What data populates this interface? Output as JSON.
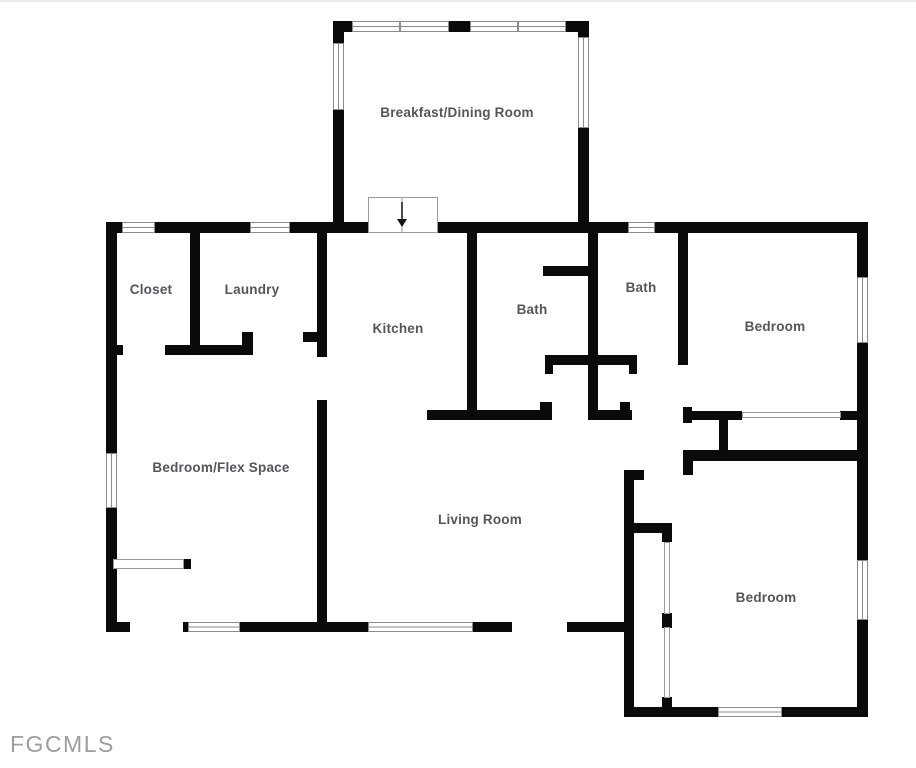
{
  "watermark": {
    "text": "FGCMLS"
  },
  "colors": {
    "background": "#ffffff",
    "wall": "#0a0a0a",
    "label": "#55555c",
    "window_stroke": "#8b8b8b",
    "watermark": "#9d9d9d",
    "page_top_edge": "#ebebe9"
  },
  "plan": {
    "canvas": {
      "width": 916,
      "height": 768
    },
    "rooms": [
      {
        "id": "breakfast-dining-room",
        "label": "Breakfast/Dining Room",
        "cx": 457,
        "cy": 117
      },
      {
        "id": "closet",
        "label": "Closet",
        "cx": 151,
        "cy": 294
      },
      {
        "id": "laundry",
        "label": "Laundry",
        "cx": 252,
        "cy": 294
      },
      {
        "id": "kitchen",
        "label": "Kitchen",
        "cx": 398,
        "cy": 333
      },
      {
        "id": "bath-center",
        "label": "Bath",
        "cx": 532,
        "cy": 314
      },
      {
        "id": "bath-right",
        "label": "Bath",
        "cx": 641,
        "cy": 292
      },
      {
        "id": "bedroom-right",
        "label": "Bedroom",
        "cx": 775,
        "cy": 331
      },
      {
        "id": "bedroom-flex-space",
        "label": "Bedroom/Flex Space",
        "cx": 221,
        "cy": 472
      },
      {
        "id": "living-room",
        "label": "Living Room",
        "cx": 480,
        "cy": 524
      },
      {
        "id": "bedroom-bottom",
        "label": "Bedroom",
        "cx": 766,
        "cy": 602
      }
    ],
    "walls": [
      [
        333,
        21,
        256,
        11
      ],
      [
        333,
        21,
        11,
        211
      ],
      [
        578,
        21,
        11,
        202
      ],
      [
        106,
        222,
        762,
        11
      ],
      [
        106,
        222,
        11,
        410
      ],
      [
        857,
        222,
        11,
        495
      ],
      [
        106,
        622,
        528,
        10
      ],
      [
        624,
        470,
        10,
        247
      ],
      [
        624,
        470,
        20,
        10
      ],
      [
        624,
        707,
        244,
        10
      ],
      [
        683,
        450,
        174,
        11
      ],
      [
        683,
        450,
        10,
        25
      ],
      [
        634,
        523,
        38,
        10
      ],
      [
        662,
        523,
        10,
        19
      ],
      [
        662,
        613,
        10,
        15
      ],
      [
        662,
        697,
        10,
        20
      ],
      [
        683,
        407,
        9,
        16
      ],
      [
        683,
        411,
        59,
        9
      ],
      [
        840,
        411,
        17,
        9
      ],
      [
        719,
        420,
        9,
        30
      ],
      [
        467,
        232,
        10,
        180
      ],
      [
        427,
        410,
        125,
        10
      ],
      [
        540,
        402,
        12,
        8
      ],
      [
        543,
        266,
        55,
        10
      ],
      [
        588,
        232,
        10,
        181
      ],
      [
        588,
        410,
        44,
        10
      ],
      [
        620,
        402,
        10,
        8
      ],
      [
        545,
        355,
        92,
        10
      ],
      [
        545,
        365,
        8,
        9
      ],
      [
        629,
        365,
        8,
        9
      ],
      [
        678,
        232,
        10,
        133
      ],
      [
        190,
        232,
        10,
        123
      ],
      [
        165,
        345,
        80,
        10
      ],
      [
        117,
        345,
        6,
        10
      ],
      [
        242,
        332,
        11,
        23
      ],
      [
        303,
        332,
        24,
        10
      ],
      [
        317,
        232,
        10,
        400
      ],
      [
        183,
        559,
        8,
        10
      ]
    ],
    "openings": [
      [
        368,
        222,
        67,
        11
      ],
      [
        130,
        622,
        53,
        10
      ],
      [
        512,
        622,
        55,
        10
      ],
      [
        317,
        357,
        10,
        43
      ]
    ],
    "windows": [
      {
        "x": 352,
        "y": 21,
        "w": 48,
        "h": 11,
        "o": "h"
      },
      {
        "x": 400,
        "y": 21,
        "w": 49,
        "h": 11,
        "o": "h"
      },
      {
        "x": 470,
        "y": 21,
        "w": 48,
        "h": 11,
        "o": "h"
      },
      {
        "x": 518,
        "y": 21,
        "w": 48,
        "h": 11,
        "o": "h"
      },
      {
        "x": 333,
        "y": 43,
        "w": 11,
        "h": 67,
        "o": "v"
      },
      {
        "x": 578,
        "y": 37,
        "w": 11,
        "h": 91,
        "o": "v"
      },
      {
        "x": 122,
        "y": 222,
        "w": 33,
        "h": 11,
        "o": "h"
      },
      {
        "x": 250,
        "y": 222,
        "w": 40,
        "h": 11,
        "o": "h"
      },
      {
        "x": 628,
        "y": 222,
        "w": 27,
        "h": 11,
        "o": "h"
      },
      {
        "x": 106,
        "y": 453,
        "w": 11,
        "h": 55,
        "o": "v"
      },
      {
        "x": 857,
        "y": 277,
        "w": 11,
        "h": 66,
        "o": "v"
      },
      {
        "x": 857,
        "y": 560,
        "w": 11,
        "h": 60,
        "o": "v"
      },
      {
        "x": 188,
        "y": 622,
        "w": 52,
        "h": 10,
        "o": "h"
      },
      {
        "x": 368,
        "y": 622,
        "w": 105,
        "h": 10,
        "o": "h"
      },
      {
        "x": 718,
        "y": 707,
        "w": 64,
        "h": 10,
        "o": "h"
      }
    ],
    "door_lines": [
      {
        "x": 742,
        "y": 412,
        "w": 98,
        "h": 5
      },
      {
        "x": 664,
        "y": 542,
        "w": 5,
        "h": 71
      },
      {
        "x": 664,
        "y": 627,
        "w": 5,
        "h": 70
      },
      {
        "x": 113,
        "y": 559,
        "w": 70,
        "h": 9
      }
    ],
    "stairs": {
      "x": 368,
      "y": 197,
      "w": 69,
      "h": 35,
      "divider_x": 402,
      "arrow": {
        "x": 402,
        "y1": 202,
        "y2": 219,
        "tip": 227,
        "half_width": 5
      }
    }
  }
}
